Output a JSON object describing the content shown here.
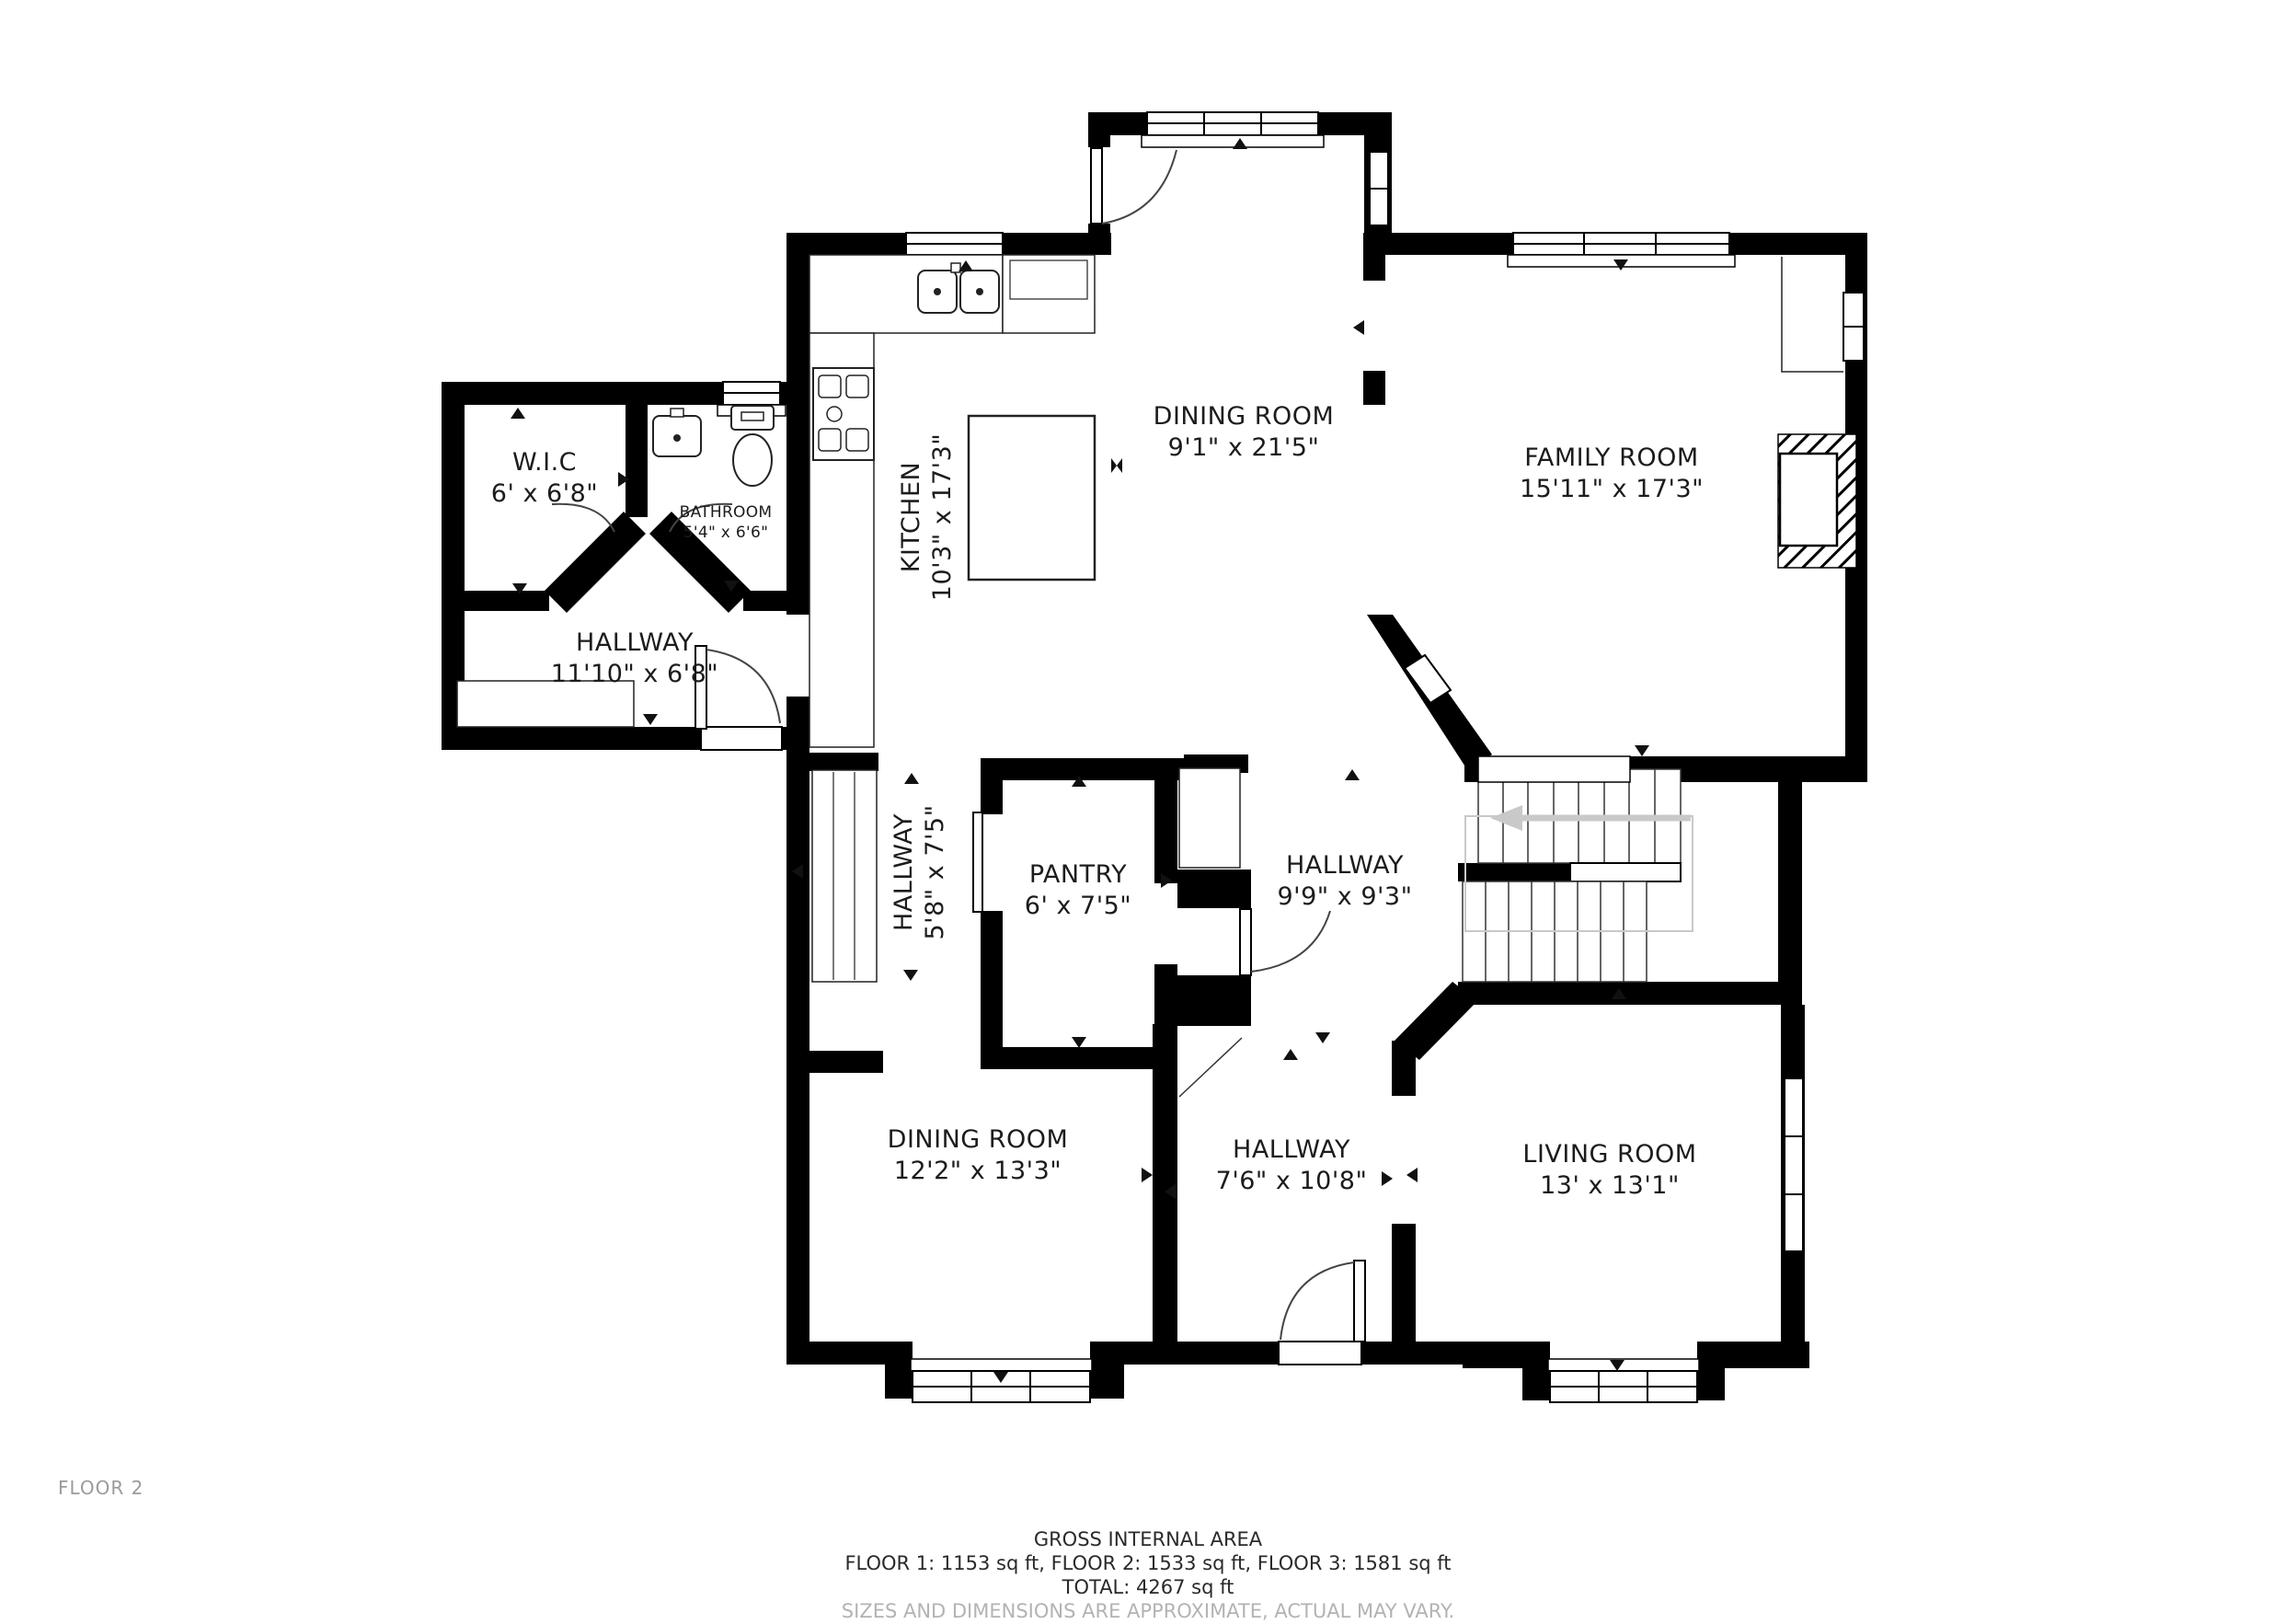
{
  "floor_label": "FLOOR 2",
  "rooms": [
    {
      "name": "W.I.C",
      "dims": "6' x 6'8\""
    },
    {
      "name": "BATHROOM",
      "dims": "5'4\" x 6'6\""
    },
    {
      "name": "HALLWAY",
      "dims": "11'10\" x 6'8\""
    },
    {
      "name": "KITCHEN",
      "dims": "10'3\" x 17'3\""
    },
    {
      "name": "DINING ROOM",
      "dims": "9'1\" x 21'5\""
    },
    {
      "name": "FAMILY ROOM",
      "dims": "15'11\" x 17'3\""
    },
    {
      "name": "HALLWAY",
      "dims": "5'8\" x 7'5\""
    },
    {
      "name": "PANTRY",
      "dims": "6' x 7'5\""
    },
    {
      "name": "HALLWAY",
      "dims": "9'9\" x 9'3\""
    },
    {
      "name": "DINING ROOM",
      "dims": "12'2\" x 13'3\""
    },
    {
      "name": "HALLWAY",
      "dims": "7'6\" x 10'8\""
    },
    {
      "name": "LIVING ROOM",
      "dims": "13' x 13'1\""
    }
  ],
  "fixtures": [
    "bathroom-sink",
    "toilet",
    "stove",
    "double-kitchen-sink",
    "kitchen-island",
    "refrigerator",
    "closet",
    "staircase",
    "fireplace",
    "bay-window"
  ],
  "footer": {
    "title": "GROSS INTERNAL AREA",
    "floors": "FLOOR 1: 1153 sq ft, FLOOR 2: 1533 sq ft, FLOOR 3: 1581 sq ft",
    "total": "TOTAL: 4267 sq ft",
    "disclaimer": "SIZES AND DIMENSIONS ARE APPROXIMATE, ACTUAL MAY VARY."
  },
  "colors": {
    "wall": "#000000",
    "line": "#333333",
    "label": "#1c1c1c",
    "muted_text": "#9b9b9b",
    "stair_guide": "#c9c9c9",
    "background": "#ffffff"
  }
}
